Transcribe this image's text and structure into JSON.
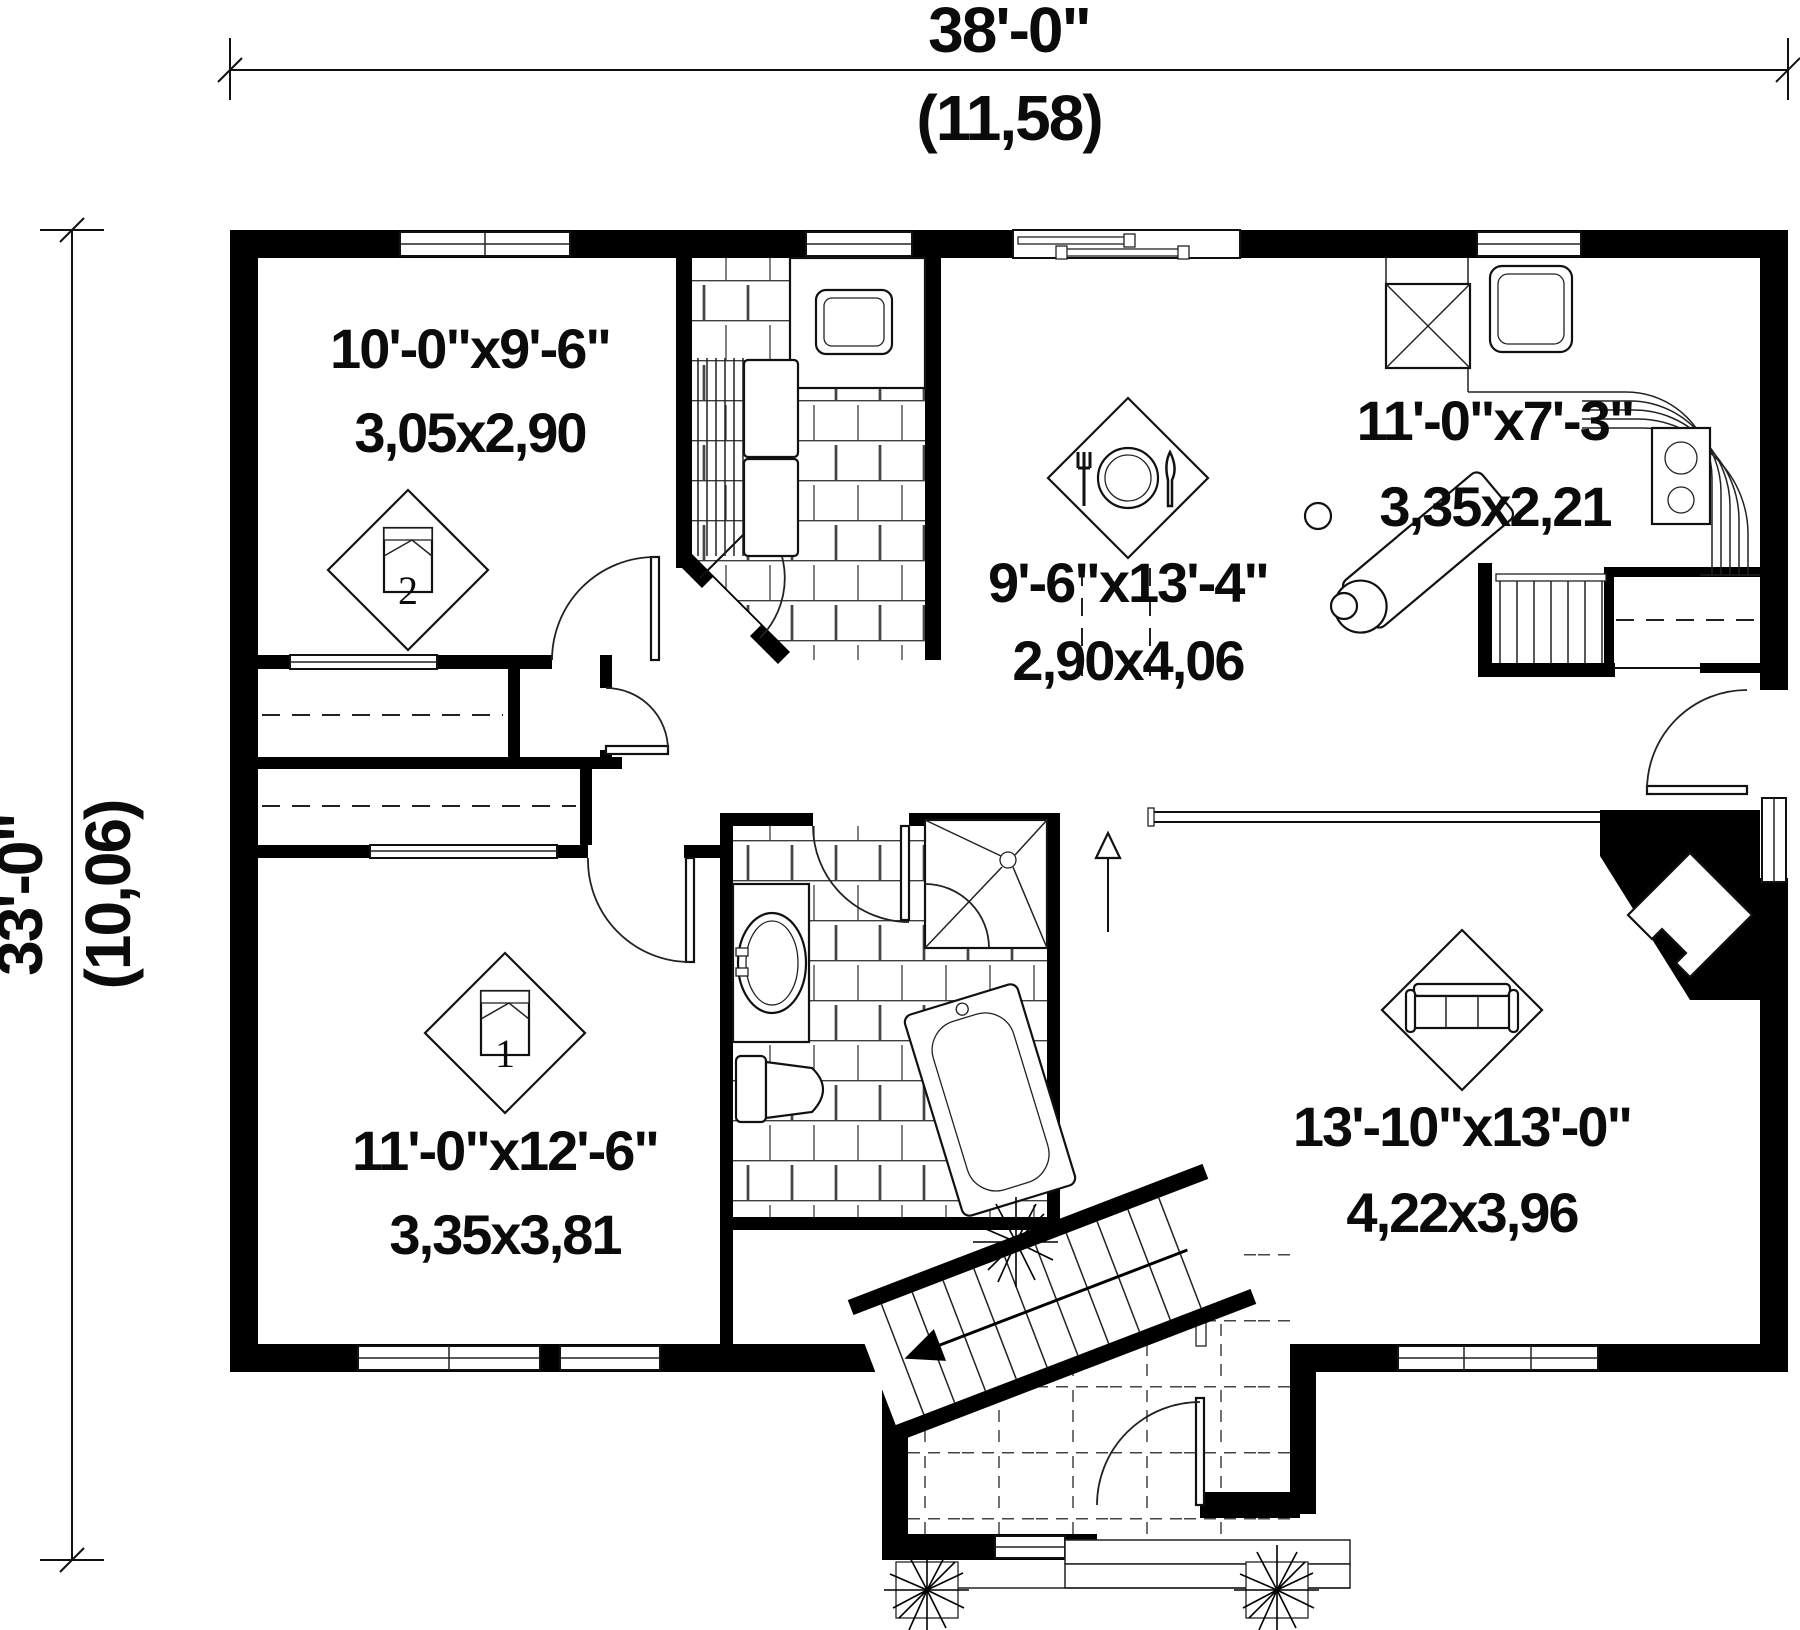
{
  "plan": {
    "type": "house-first-floor-plan",
    "dimensions": {
      "width_imperial": "38'-0\"",
      "width_metric": "(11,58)",
      "height_imperial": "33'-0\"",
      "height_metric": "(10,06)"
    },
    "rooms": {
      "bedroom2": {
        "imperial": "10'-0\"x9'-6\"",
        "metric": "3,05x2,90",
        "number": "2"
      },
      "dining": {
        "imperial": "9'-6\"x13'-4\"",
        "metric": "2,90x4,06"
      },
      "kitchen": {
        "imperial": "11'-0\"x7'-3\"",
        "metric": "3,35x2,21"
      },
      "bedroom1": {
        "imperial": "11'-0\"x12'-6\"",
        "metric": "3,35x3,81",
        "number": "1"
      },
      "living": {
        "imperial": "13'-10\"x13'-0\"",
        "metric": "4,22x3,96"
      }
    },
    "colors": {
      "wall": "#000000",
      "background": "#ffffff",
      "line": "#111111"
    }
  }
}
